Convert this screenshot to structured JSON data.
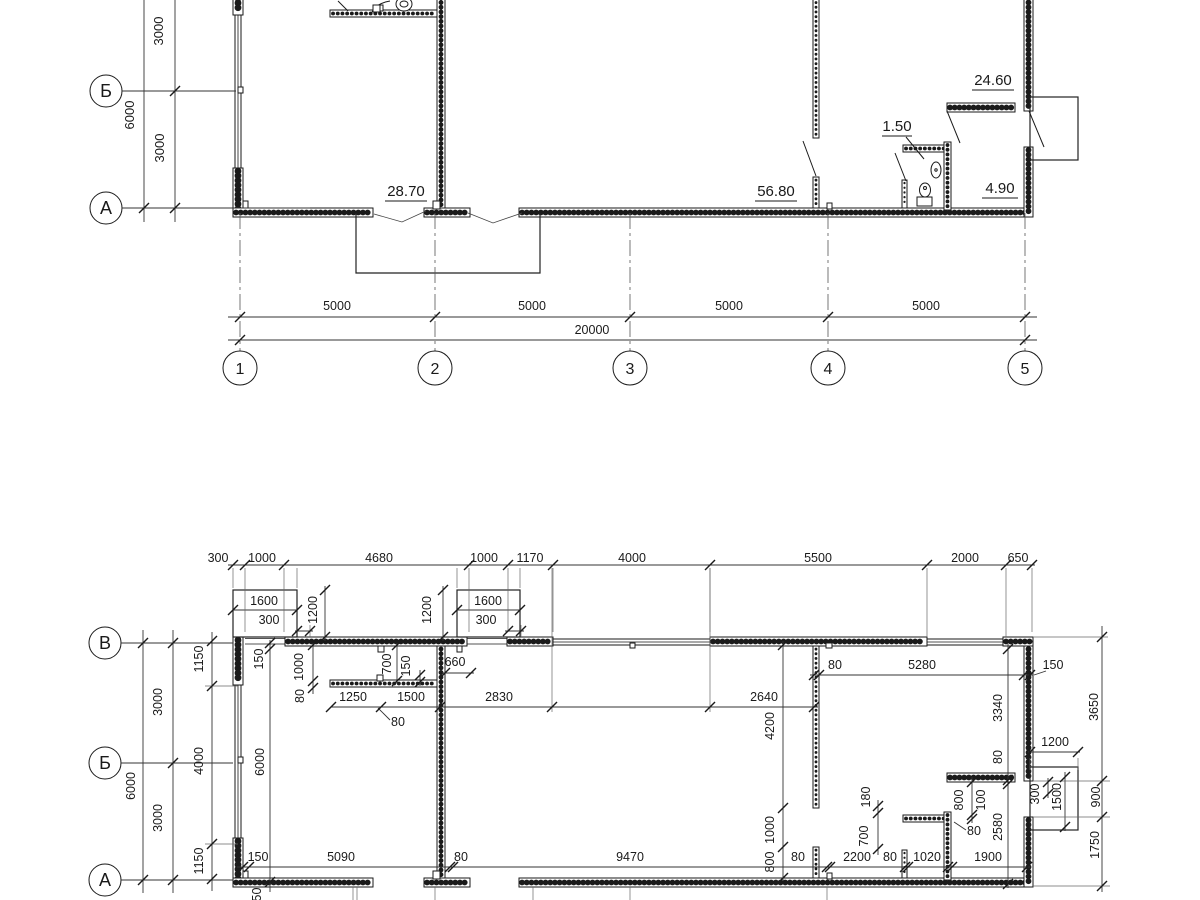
{
  "drawing_title": "floor-plan",
  "upper_plan": {
    "row_axes": [
      "Б",
      "А"
    ],
    "col_axes": [
      "1",
      "2",
      "3",
      "4",
      "5"
    ],
    "left_dims": [
      "3000",
      "6000",
      "3000"
    ],
    "span_dims": [
      "5000",
      "5000",
      "5000",
      "5000"
    ],
    "total_dim": "20000",
    "room_areas": [
      "28.70",
      "56.80",
      "1.50",
      "24.60",
      "4.90"
    ]
  },
  "lower_plan": {
    "row_axes": [
      "В",
      "Б",
      "А"
    ],
    "labels": [
      {
        "text": "300",
        "x": 218,
        "y": 562
      },
      {
        "text": "1000",
        "x": 262,
        "y": 562
      },
      {
        "text": "4680",
        "x": 379,
        "y": 562
      },
      {
        "text": "1000",
        "x": 484,
        "y": 562
      },
      {
        "text": "1170",
        "x": 530,
        "y": 562
      },
      {
        "text": "4000",
        "x": 632,
        "y": 562
      },
      {
        "text": "5500",
        "x": 818,
        "y": 562
      },
      {
        "text": "2000",
        "x": 965,
        "y": 562
      },
      {
        "text": "650",
        "x": 1018,
        "y": 562
      },
      {
        "text": "1600",
        "x": 264,
        "y": 605
      },
      {
        "text": "300",
        "x": 269,
        "y": 624
      },
      {
        "text": "1200",
        "x": 317,
        "y": 610,
        "rot": true
      },
      {
        "text": "1600",
        "x": 488,
        "y": 605
      },
      {
        "text": "300",
        "x": 486,
        "y": 624
      },
      {
        "text": "1200",
        "x": 431,
        "y": 610,
        "rot": true
      },
      {
        "text": "1150",
        "x": 203,
        "y": 659,
        "rot": true
      },
      {
        "text": "4000",
        "x": 203,
        "y": 761,
        "rot": true
      },
      {
        "text": "1150",
        "x": 203,
        "y": 861,
        "rot": true
      },
      {
        "text": "3000",
        "x": 162,
        "y": 702,
        "rot": true
      },
      {
        "text": "6000",
        "x": 135,
        "y": 786,
        "rot": true
      },
      {
        "text": "3000",
        "x": 162,
        "y": 818,
        "rot": true
      },
      {
        "text": "150",
        "x": 263,
        "y": 659,
        "rot": true
      },
      {
        "text": "6000",
        "x": 264,
        "y": 762,
        "rot": true
      },
      {
        "text": "1000",
        "x": 303,
        "y": 667,
        "rot": true
      },
      {
        "text": "80",
        "x": 304,
        "y": 696,
        "rot": true
      },
      {
        "text": "700",
        "x": 391,
        "y": 664,
        "rot": true
      },
      {
        "text": "150",
        "x": 410,
        "y": 666,
        "rot": true
      },
      {
        "text": "660",
        "x": 455,
        "y": 666
      },
      {
        "text": "1250",
        "x": 353,
        "y": 701
      },
      {
        "text": "1500",
        "x": 411,
        "y": 701
      },
      {
        "text": "2830",
        "x": 499,
        "y": 701
      },
      {
        "text": "80",
        "x": 398,
        "y": 726
      },
      {
        "text": "2640",
        "x": 764,
        "y": 701
      },
      {
        "text": "4200",
        "x": 774,
        "y": 726,
        "rot": true
      },
      {
        "text": "1000",
        "x": 774,
        "y": 830,
        "rot": true
      },
      {
        "text": "800",
        "x": 774,
        "y": 862,
        "rot": true
      },
      {
        "text": "80",
        "x": 835,
        "y": 669
      },
      {
        "text": "5280",
        "x": 922,
        "y": 669
      },
      {
        "text": "150",
        "x": 1053,
        "y": 669
      },
      {
        "text": "3340",
        "x": 1002,
        "y": 708,
        "rot": true
      },
      {
        "text": "80",
        "x": 1002,
        "y": 757,
        "rot": true
      },
      {
        "text": "2580",
        "x": 1002,
        "y": 827,
        "rot": true
      },
      {
        "text": "3650",
        "x": 1098,
        "y": 707,
        "rot": true
      },
      {
        "text": "900",
        "x": 1100,
        "y": 797,
        "rot": true
      },
      {
        "text": "1750",
        "x": 1099,
        "y": 845,
        "rot": true
      },
      {
        "text": "1200",
        "x": 1055,
        "y": 746
      },
      {
        "text": "300",
        "x": 1039,
        "y": 794,
        "rot": true
      },
      {
        "text": "1500",
        "x": 1061,
        "y": 797,
        "rot": true
      },
      {
        "text": "180",
        "x": 870,
        "y": 797,
        "rot": true
      },
      {
        "text": "700",
        "x": 868,
        "y": 836,
        "rot": true
      },
      {
        "text": "800",
        "x": 963,
        "y": 800,
        "rot": true
      },
      {
        "text": "100",
        "x": 985,
        "y": 800,
        "rot": true
      },
      {
        "text": "80",
        "x": 974,
        "y": 835
      },
      {
        "text": "150",
        "x": 258,
        "y": 861
      },
      {
        "text": "5090",
        "x": 341,
        "y": 861
      },
      {
        "text": "80",
        "x": 461,
        "y": 861
      },
      {
        "text": "9470",
        "x": 630,
        "y": 861
      },
      {
        "text": "80",
        "x": 798,
        "y": 861
      },
      {
        "text": "2200",
        "x": 857,
        "y": 861
      },
      {
        "text": "80",
        "x": 890,
        "y": 861
      },
      {
        "text": "1020",
        "x": 927,
        "y": 861
      },
      {
        "text": "1900",
        "x": 988,
        "y": 861
      },
      {
        "text": "150",
        "x": 261,
        "y": 898,
        "rot": true
      }
    ]
  }
}
